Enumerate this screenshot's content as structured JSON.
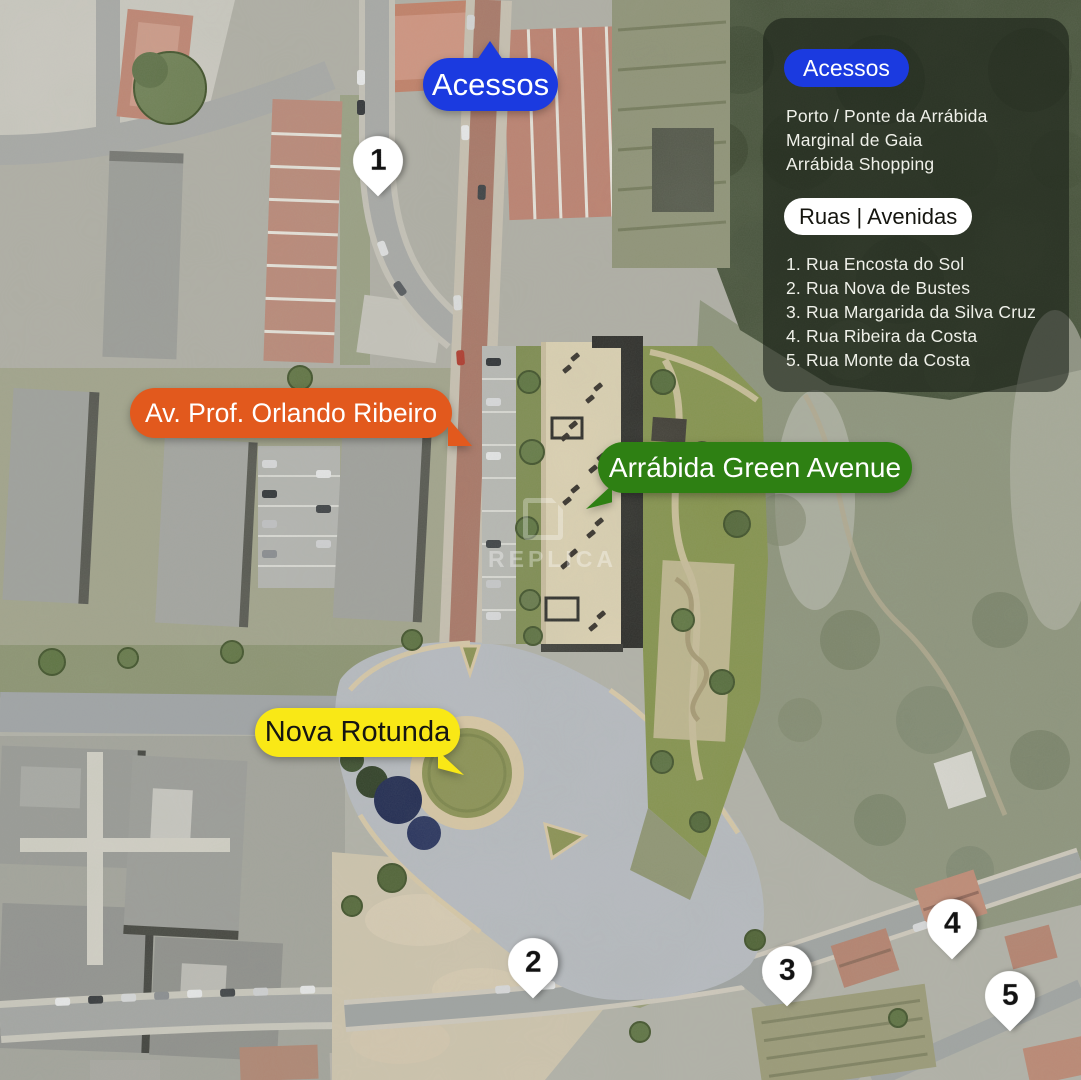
{
  "watermark": {
    "text": "REPLICA"
  },
  "colors": {
    "accent_blue": "#1b3ae0",
    "accent_orange": "#e2591d",
    "accent_green": "#2e8013",
    "accent_yellow": "#f9e816",
    "panel_bg": "rgba(22,30,20,0.58)",
    "pin_bg": "#ffffff"
  },
  "callouts": {
    "acessos": {
      "label": "Acessos"
    },
    "avenida": {
      "label": "Av. Prof. Orlando Ribeiro"
    },
    "projeto": {
      "label": "Arrábida Green Avenue"
    },
    "rotunda": {
      "label": "Nova Rotunda"
    }
  },
  "pins": [
    {
      "number": "1"
    },
    {
      "number": "2"
    },
    {
      "number": "3"
    },
    {
      "number": "4"
    },
    {
      "number": "5"
    }
  ],
  "legend_panel": {
    "acessos_title": "Acessos",
    "acessos_items": [
      "Porto / Ponte da Arrábida",
      "Marginal de Gaia",
      "Arrábida Shopping"
    ],
    "ruas_title": "Ruas | Avenidas",
    "ruas_items": [
      "1. Rua Encosta do Sol",
      "2. Rua Nova de Bustes",
      "3. Rua Margarida da Silva Cruz",
      "4. Rua Ribeira da Costa",
      "5. Rua Monte da Costa"
    ]
  }
}
